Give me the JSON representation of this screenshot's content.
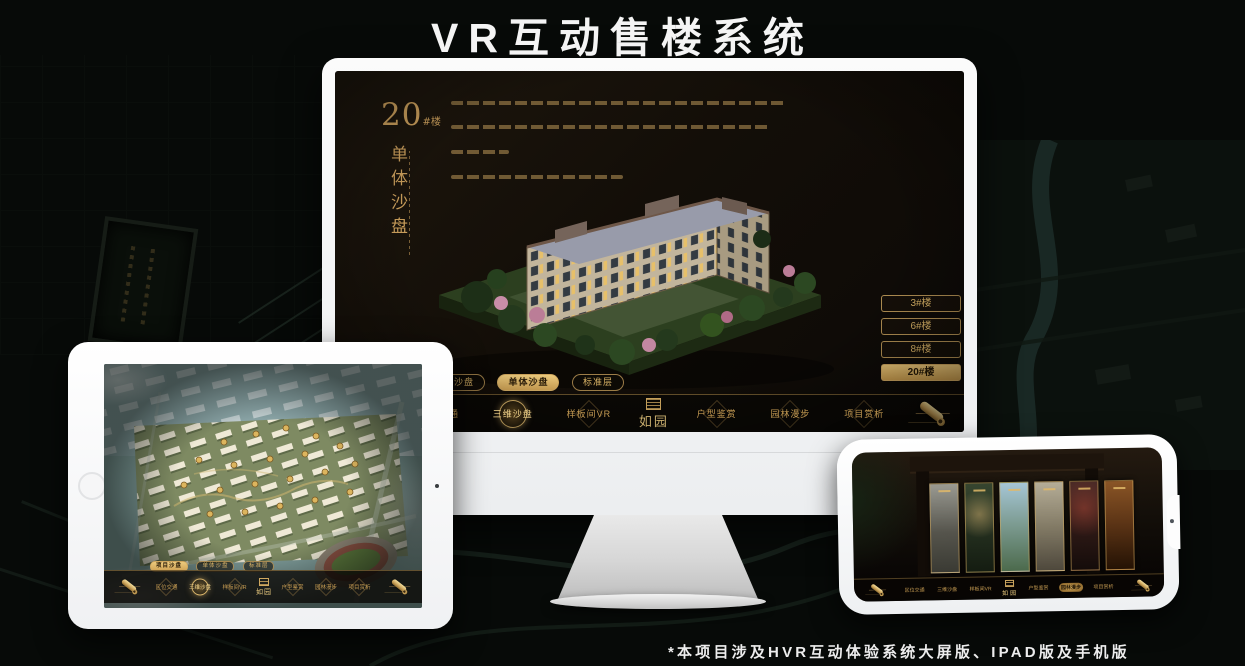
{
  "header": {
    "title": "VR互动售楼系统"
  },
  "footer": {
    "note": "*本项目涉及HVR互动体验系统大屏版、IPAD版及手机版"
  },
  "brand": {
    "logo_text": "如园",
    "seal_icon": "seal-icon"
  },
  "colors": {
    "accent_gold": "#d2a75f",
    "active_gold_fill": "#cfa254",
    "screen_dark": "#130e08",
    "device_white": "#f5f6f7"
  },
  "desktop": {
    "block_title": "20",
    "block_title_suffix": "#楼",
    "section_vertical_title": "单体沙盘",
    "sub_tabs": [
      {
        "label": "项目沙盘",
        "active": false
      },
      {
        "label": "单体沙盘",
        "active": true
      },
      {
        "label": "标准层",
        "active": false
      }
    ],
    "floor_buttons": [
      {
        "label": "3#楼",
        "active": false
      },
      {
        "label": "6#楼",
        "active": false
      },
      {
        "label": "8#楼",
        "active": false
      },
      {
        "label": "20#楼",
        "active": true
      }
    ],
    "nav": {
      "items_left": [
        {
          "label": "区位交通",
          "active": false
        },
        {
          "label": "三维沙盘",
          "active": true
        },
        {
          "label": "样板间VR",
          "active": false
        }
      ],
      "items_right": [
        {
          "label": "户型鉴赏",
          "active": false
        },
        {
          "label": "园林漫步",
          "active": false
        },
        {
          "label": "项目赏析",
          "active": false
        }
      ],
      "scroll_icon": "scroll-icon"
    }
  },
  "tablet": {
    "sub_tabs": [
      {
        "label": "项目沙盘",
        "active": true
      },
      {
        "label": "单体沙盘",
        "active": false
      },
      {
        "label": "标准层",
        "active": false
      }
    ],
    "nav": {
      "items_left": [
        {
          "label": "区位交通",
          "active": false
        },
        {
          "label": "三维沙盘",
          "active": true
        },
        {
          "label": "样板间VR",
          "active": false
        }
      ],
      "items_right": [
        {
          "label": "户型鉴赏",
          "active": false
        },
        {
          "label": "园林漫步",
          "active": false
        },
        {
          "label": "项目赏析",
          "active": false
        }
      ]
    }
  },
  "phone": {
    "nav": {
      "items_left": [
        {
          "label": "区位交通",
          "active": false
        },
        {
          "label": "三维沙盘",
          "active": false
        },
        {
          "label": "样板间VR",
          "active": false
        }
      ],
      "items_right": [
        {
          "label": "户型鉴赏",
          "active": false
        },
        {
          "label": "园林漫步",
          "active": true
        },
        {
          "label": "项目赏析",
          "active": false
        }
      ]
    }
  }
}
